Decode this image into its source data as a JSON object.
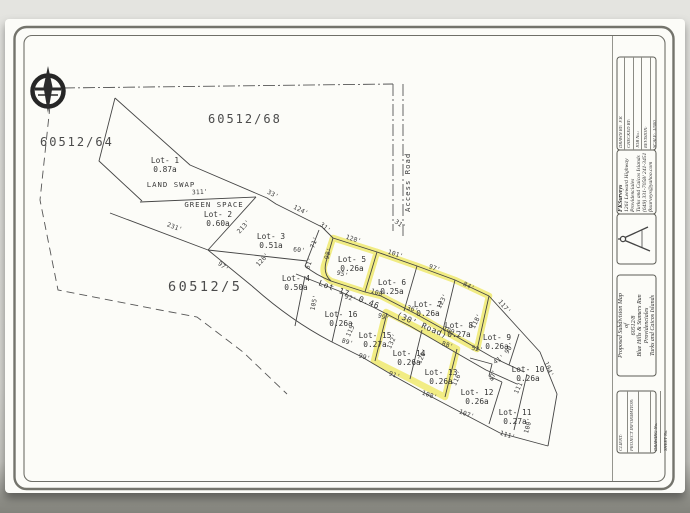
{
  "map": {
    "parcel_labels": [
      {
        "text": "60512/68",
        "x": 208,
        "y": 123,
        "cls": "parcel"
      },
      {
        "text": "60512/64",
        "x": 40,
        "y": 146,
        "cls": "parcel"
      },
      {
        "text": "60512/5",
        "x": 168,
        "y": 291,
        "cls": "parcel-big"
      }
    ],
    "annotations": [
      {
        "text": "LAND SWAP",
        "x": 171,
        "y": 187,
        "a": 0
      },
      {
        "text": "GREEN SPACE",
        "x": 214,
        "y": 207,
        "a": 0
      },
      {
        "text": "Access Road",
        "x": 410,
        "y": 212,
        "a": -90
      }
    ],
    "road_label_parts": [
      {
        "t": "Lot 17",
        "x": 318,
        "y": 285,
        "a": 21
      },
      {
        "t": "0.46",
        "x": 358,
        "y": 301,
        "a": 21
      },
      {
        "t": "(30' Road)",
        "x": 396,
        "y": 317,
        "a": 23
      }
    ],
    "lots": [
      {
        "name": "Lot- 1",
        "area": "0.87a",
        "x": 165,
        "y": 163,
        "highlighted": false
      },
      {
        "name": "Lot- 2",
        "area": "0.60a",
        "x": 218,
        "y": 217,
        "highlighted": false
      },
      {
        "name": "Lot- 3",
        "area": "0.51a",
        "x": 271,
        "y": 239,
        "highlighted": false
      },
      {
        "name": "Lot- 4",
        "area": "0.50a",
        "x": 296,
        "y": 281,
        "highlighted": false
      },
      {
        "name": "Lot- 5",
        "area": "0.26a",
        "x": 352,
        "y": 262,
        "highlighted": true
      },
      {
        "name": "Lot- 6",
        "area": "0.25a",
        "x": 392,
        "y": 285,
        "highlighted": false
      },
      {
        "name": "Lot- 7",
        "area": "0.26a",
        "x": 428,
        "y": 307,
        "highlighted": false
      },
      {
        "name": "Lot- 8",
        "area": "0.27a",
        "x": 459,
        "y": 328,
        "highlighted": false
      },
      {
        "name": "Lot- 9",
        "area": "0.26a",
        "x": 497,
        "y": 340,
        "highlighted": false
      },
      {
        "name": "Lot- 10",
        "area": "0.26a",
        "x": 528,
        "y": 372,
        "highlighted": false
      },
      {
        "name": "Lot- 11",
        "area": "0.27a",
        "x": 515,
        "y": 415,
        "highlighted": false
      },
      {
        "name": "Lot- 12",
        "area": "0.26a",
        "x": 477,
        "y": 395,
        "highlighted": false
      },
      {
        "name": "Lot- 13",
        "area": "0.26a",
        "x": 441,
        "y": 375,
        "highlighted": true
      },
      {
        "name": "Lot- 14",
        "area": "0.26a",
        "x": 409,
        "y": 356,
        "highlighted": true
      },
      {
        "name": "Lot- 15",
        "area": "0.27a",
        "x": 375,
        "y": 338,
        "highlighted": false
      },
      {
        "name": "Lot- 16",
        "area": "0.26a",
        "x": 341,
        "y": 317,
        "highlighted": false
      }
    ],
    "dimensions": [
      {
        "t": "311'",
        "x": 200,
        "y": 194,
        "a": -3
      },
      {
        "t": "33'",
        "x": 272,
        "y": 196,
        "a": 28
      },
      {
        "t": "124'",
        "x": 300,
        "y": 212,
        "a": 27
      },
      {
        "t": "31'",
        "x": 324,
        "y": 229,
        "a": 40
      },
      {
        "t": "31'",
        "x": 399,
        "y": 226,
        "a": 35
      },
      {
        "t": "213'",
        "x": 245,
        "y": 228,
        "a": -48
      },
      {
        "t": "231'",
        "x": 174,
        "y": 229,
        "a": 21
      },
      {
        "t": "97'",
        "x": 222,
        "y": 268,
        "a": 39
      },
      {
        "t": "71'",
        "x": 316,
        "y": 243,
        "a": -70
      },
      {
        "t": "60'",
        "x": 299,
        "y": 252,
        "a": 6
      },
      {
        "t": "61'",
        "x": 311,
        "y": 264,
        "a": -70
      },
      {
        "t": "126'",
        "x": 264,
        "y": 261,
        "a": -48
      },
      {
        "t": "128'",
        "x": 353,
        "y": 241,
        "a": 17
      },
      {
        "t": "101'",
        "x": 395,
        "y": 256,
        "a": 18
      },
      {
        "t": "97'",
        "x": 434,
        "y": 270,
        "a": 20
      },
      {
        "t": "84'",
        "x": 468,
        "y": 288,
        "a": 27
      },
      {
        "t": "117'",
        "x": 503,
        "y": 308,
        "a": 50
      },
      {
        "t": "104'",
        "x": 547,
        "y": 370,
        "a": 67
      },
      {
        "t": "98'",
        "x": 330,
        "y": 254,
        "a": -73
      },
      {
        "t": "95'",
        "x": 342,
        "y": 276,
        "a": 17
      },
      {
        "t": "108'",
        "x": 378,
        "y": 295,
        "a": 18
      },
      {
        "t": "36'",
        "x": 412,
        "y": 311,
        "a": 19
      },
      {
        "t": "123'",
        "x": 444,
        "y": 302,
        "a": -63
      },
      {
        "t": "118'",
        "x": 478,
        "y": 322,
        "a": -63
      },
      {
        "t": "109'",
        "x": 450,
        "y": 333,
        "a": 20
      },
      {
        "t": "92'",
        "x": 350,
        "y": 300,
        "a": 18
      },
      {
        "t": "99'",
        "x": 383,
        "y": 319,
        "a": 19
      },
      {
        "t": "105'",
        "x": 316,
        "y": 303,
        "a": -78
      },
      {
        "t": "115'",
        "x": 353,
        "y": 330,
        "a": -65
      },
      {
        "t": "132'",
        "x": 394,
        "y": 342,
        "a": -65
      },
      {
        "t": "120'",
        "x": 424,
        "y": 357,
        "a": -65
      },
      {
        "t": "116'",
        "x": 459,
        "y": 379,
        "a": -65
      },
      {
        "t": "89'",
        "x": 347,
        "y": 344,
        "a": 17
      },
      {
        "t": "99'",
        "x": 364,
        "y": 359,
        "a": 18
      },
      {
        "t": "91'",
        "x": 394,
        "y": 377,
        "a": 19
      },
      {
        "t": "108'",
        "x": 429,
        "y": 397,
        "a": 19
      },
      {
        "t": "107'",
        "x": 466,
        "y": 416,
        "a": 20
      },
      {
        "t": "111'",
        "x": 507,
        "y": 437,
        "a": 17
      },
      {
        "t": "100'",
        "x": 530,
        "y": 426,
        "a": -75
      },
      {
        "t": "111'",
        "x": 521,
        "y": 387,
        "a": -65
      },
      {
        "t": "90'",
        "x": 511,
        "y": 349,
        "a": -58
      },
      {
        "t": "88'",
        "x": 447,
        "y": 347,
        "a": 18
      },
      {
        "t": "52'",
        "x": 477,
        "y": 351,
        "a": 12
      },
      {
        "t": "41'",
        "x": 500,
        "y": 361,
        "a": -35
      },
      {
        "t": "47'",
        "x": 495,
        "y": 376,
        "a": -72
      }
    ]
  },
  "title_block": {
    "fields": [
      {
        "label": "DRAWN BY:",
        "value": "F.K"
      },
      {
        "label": "CHECKED BY:",
        "value": ""
      },
      {
        "label": "JOB No.:",
        "value": ""
      },
      {
        "label": "REVISION:",
        "value": ""
      },
      {
        "label": "SCALE:",
        "value": "1/500"
      }
    ],
    "firm": {
      "name": "FKSurveys",
      "lines": [
        "1261 Leeward Highway",
        "Providenciales",
        "Turks and Caicos Islands",
        "(649) 331-7058/ 241-3451",
        "fksurveys@yahoo.com"
      ]
    },
    "title_lines": [
      "Proposed Subdivision Map",
      "of",
      "60512/8",
      "Blue Hills & Stamers Run",
      "Providenciales",
      "Turks and Caicos Islands"
    ],
    "footer_fields": [
      "CLIENT:",
      "PROJECT INFORMATION:"
    ],
    "footer_numbers": [
      "DRAWING No.",
      "SHEET No."
    ]
  },
  "colors": {
    "highlight": "#efe967",
    "ink": "#454545",
    "frame": "#74746c"
  }
}
